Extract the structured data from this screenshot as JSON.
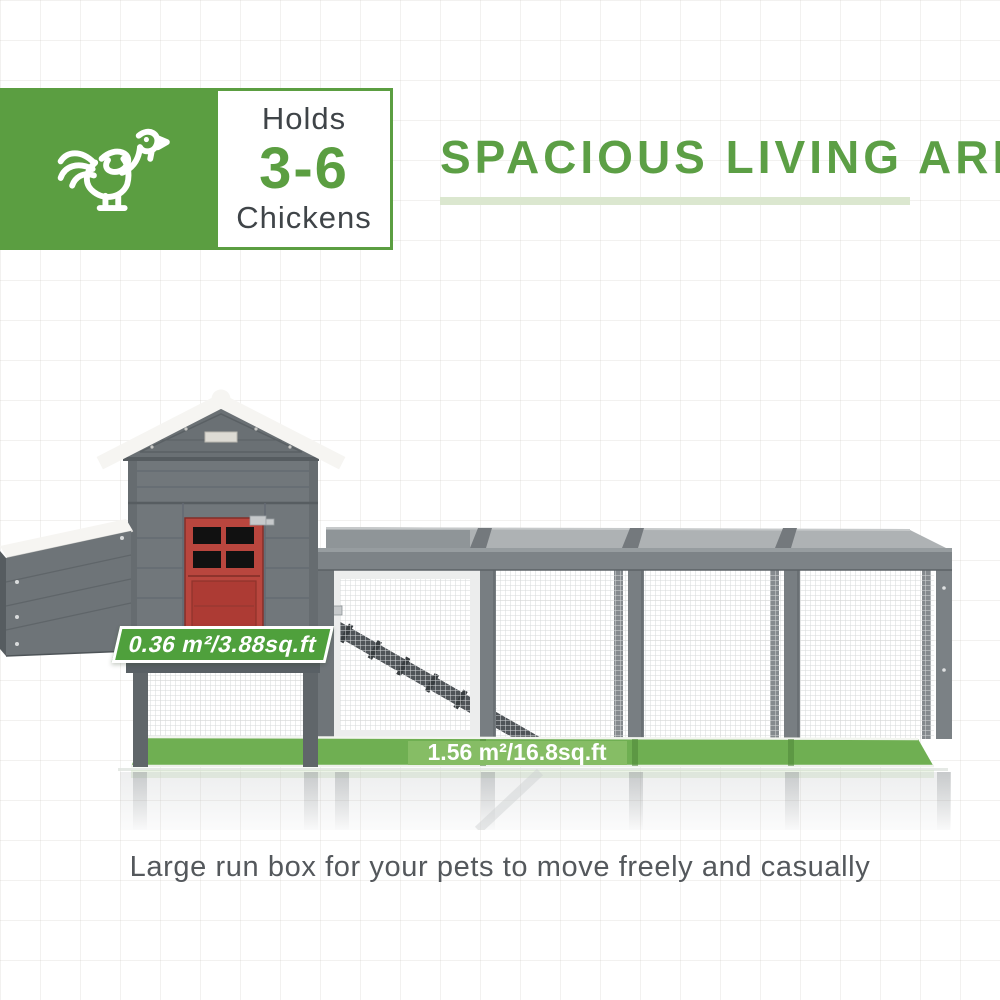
{
  "badge": {
    "icon": "chicken-icon",
    "line1": "Holds",
    "line2": "3-6",
    "line3": "Chickens",
    "green": "#5b9e41",
    "text_dark": "#3f4448"
  },
  "header": {
    "title": "SPACIOUS LIVING AREA",
    "title_color": "#5c9f45",
    "underline_color": "#dbe7cf"
  },
  "product": {
    "name": "gray chicken coop with red door and wire mesh run",
    "labels": {
      "coop_area": "0.36 m²/3.88sq.ft",
      "run_area": "1.56 m²/16.8sq.ft"
    },
    "colors": {
      "banner_green": "#4fa03c",
      "floor_green": "#6faf52",
      "floor_green_light": "#86bd65",
      "door_red": "#b9463e",
      "wood_gray": "#71777b",
      "roof_white": "#f6f5f2"
    }
  },
  "caption": {
    "text": "Large run box for your pets to move freely and casually"
  }
}
